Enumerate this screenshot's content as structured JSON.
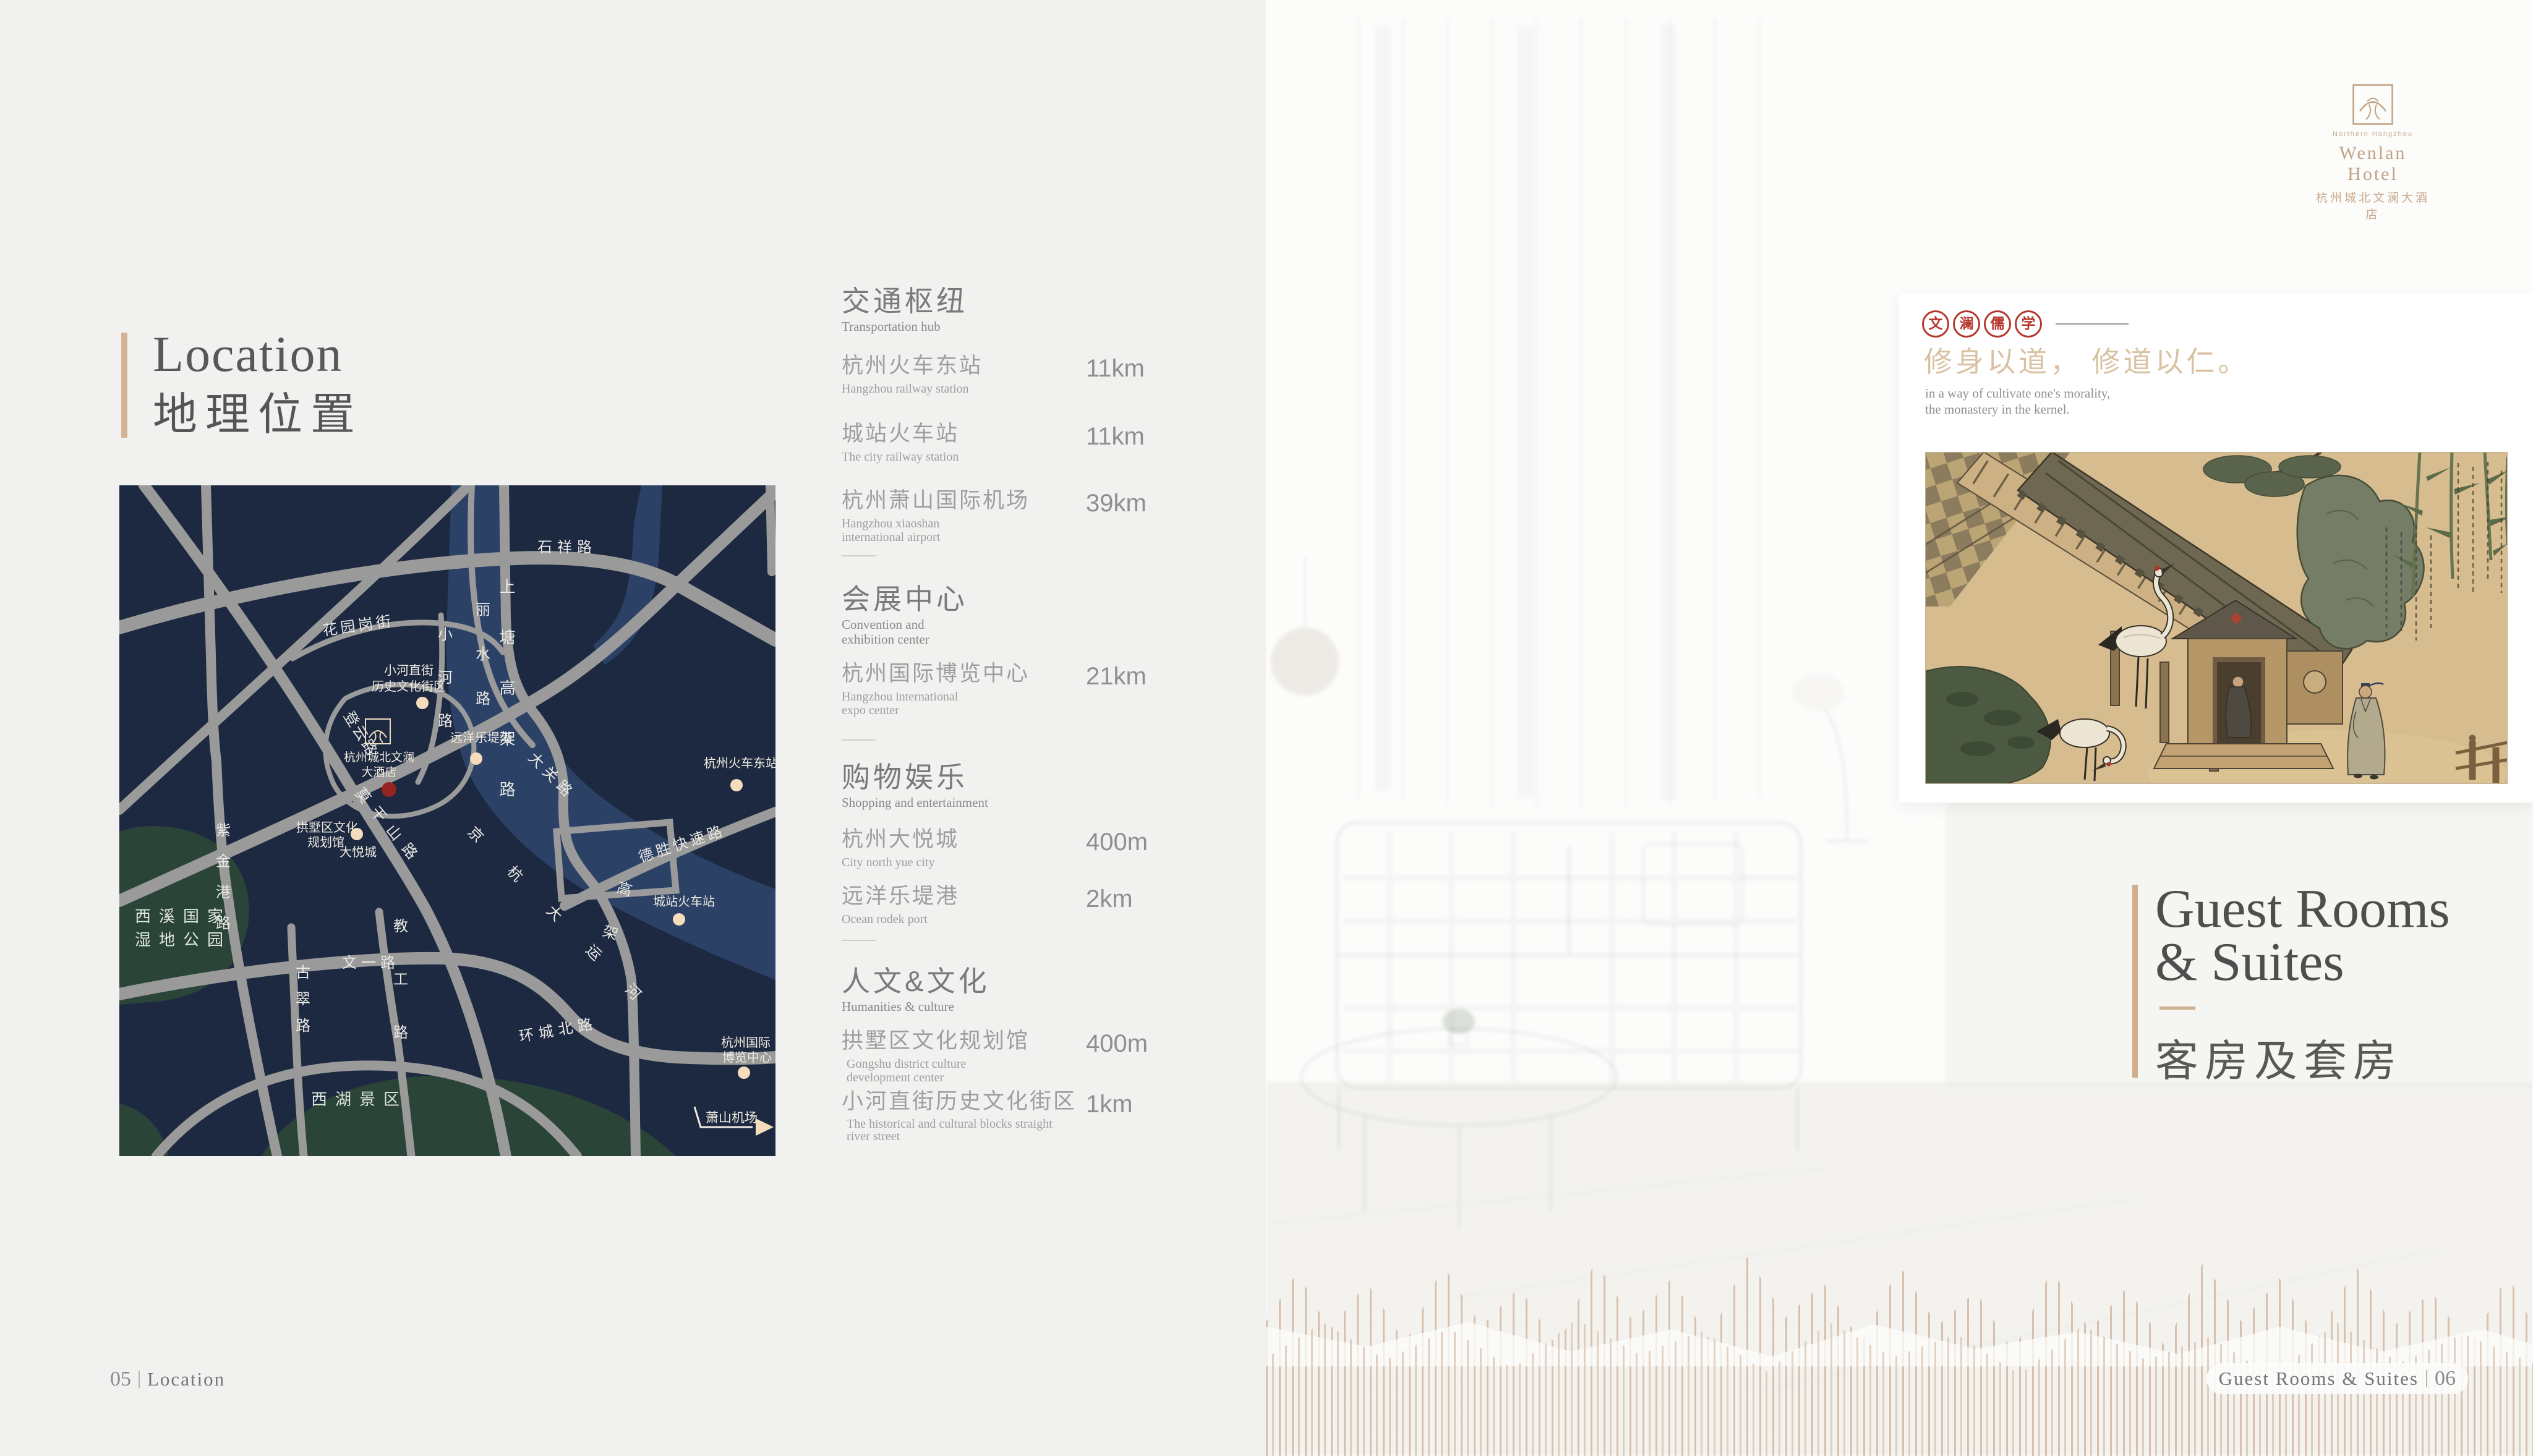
{
  "colors": {
    "accent_tan": "#cfae8d",
    "seal_red": "#b5362c",
    "map_navy": "#1d2940",
    "map_river": "#2c4166",
    "map_park": "#2a4438",
    "poi_dot": "#f4dcbd",
    "hotel_dot": "#962222"
  },
  "left": {
    "title_en": "Location",
    "title_cn": "地理位置",
    "footer": {
      "page": "05",
      "label": "Location"
    },
    "sections": [
      {
        "heading_cn": "交通枢纽",
        "heading_en": "Transportation hub",
        "items": [
          {
            "cn": "杭州火车东站",
            "en": "Hangzhou railway station",
            "dist": "11km"
          },
          {
            "cn": "城站火车站",
            "en": "The city railway station",
            "dist": "11km"
          },
          {
            "cn": "杭州萧山国际机场",
            "en": "Hangzhou xiaoshan international airport",
            "dist": "39km"
          }
        ]
      },
      {
        "heading_cn": "会展中心",
        "heading_en": "Convention and exhibition center",
        "items": [
          {
            "cn": "杭州国际博览中心",
            "en": "Hangzhou international expo center",
            "dist": "21km"
          }
        ]
      },
      {
        "heading_cn": "购物娱乐",
        "heading_en": "Shopping and entertainment",
        "items": [
          {
            "cn": "杭州大悦城",
            "en": "City north yue city",
            "dist": "400m"
          },
          {
            "cn": "远洋乐堤港",
            "en": "Ocean rodek port",
            "dist": "2km"
          }
        ]
      },
      {
        "heading_cn": "人文&文化",
        "heading_en": "Humanities & culture",
        "items": [
          {
            "cn": "拱墅区文化规划馆",
            "en": "Gongshu district culture development center",
            "dist": "400m"
          },
          {
            "cn": "小河直街历史文化街区",
            "en": "The historical and cultural blocks straight river street",
            "dist": "1km"
          }
        ]
      }
    ]
  },
  "map": {
    "roads": [
      "石祥路",
      "上塘高架路",
      "丽水路",
      "花园岗街",
      "小河路",
      "登云路",
      "莫干山路",
      "大关路",
      "紫金港路",
      "古翠路",
      "文一路",
      "教工路",
      "环城北路",
      "德胜快速路",
      "京杭大运河",
      "高架"
    ],
    "areas": [
      "西溪国家",
      "湿地公园",
      "西湖景区"
    ],
    "pois": {
      "xiaohe": {
        "line1": "小河直街",
        "line2": "历史文化街区"
      },
      "hotel": {
        "line1": "杭州城北文澜",
        "line2": "大酒店"
      },
      "east_station": "杭州火车东站",
      "ocean_port": "远洋乐堤港",
      "gongshu": {
        "line1": "拱墅区文化",
        "line2": "规划馆"
      },
      "joy_city": "大悦城",
      "city_station": "城站火车站",
      "expo": {
        "line1": "杭州国际",
        "line2": "博览中心"
      },
      "airport": "萧山机场"
    }
  },
  "right": {
    "logo": {
      "tagline": "Northern Hangzhou",
      "brand_en": "Wenlan Hotel",
      "brand_cn": "杭州城北文澜大酒店"
    },
    "seals": [
      "文",
      "澜",
      "儒",
      "学"
    ],
    "quote": {
      "calligraphy": "修身以道， 修道以仁。",
      "caption1": "in a way of cultivate one's morality,",
      "caption2": "the monastery in the kernel."
    },
    "title": {
      "line1": "Guest Rooms",
      "line2": "& Suites",
      "cn": "客房及套房"
    },
    "footer": {
      "label": "Guest Rooms & Suites",
      "page": "06"
    }
  }
}
